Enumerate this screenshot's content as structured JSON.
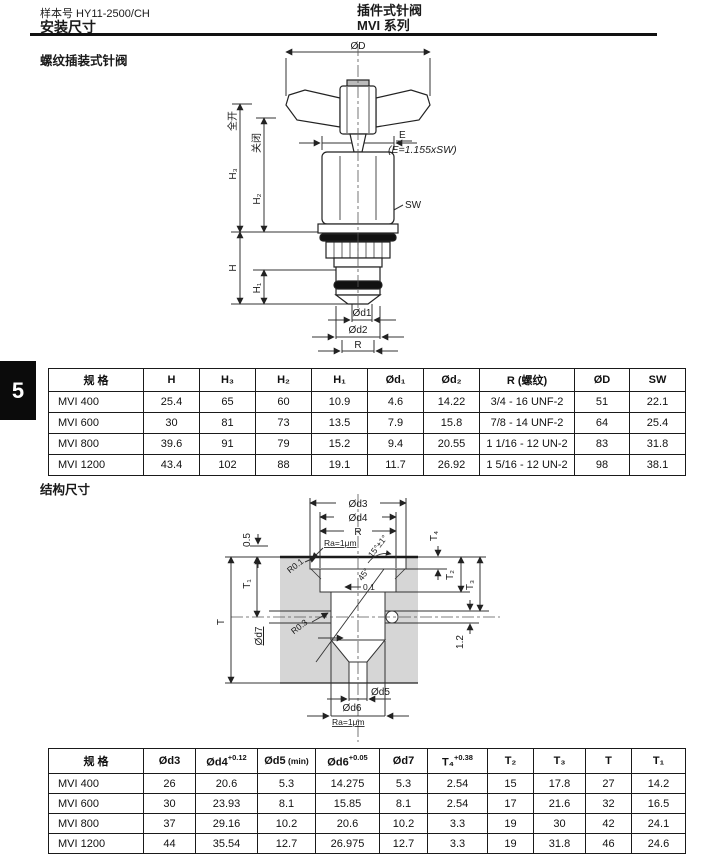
{
  "header": {
    "catalog_no": "样本号 HY11-2500/CH",
    "title_left": "安装尺寸",
    "product_title": "插件式针阀",
    "series": "MVI 系列",
    "tab_number": "5"
  },
  "sections": {
    "mounting_heading": "螺纹插装式针阀",
    "structure_heading": "结构尺寸"
  },
  "drawing1": {
    "labels": {
      "od": "ØD",
      "full_open": "全开",
      "closed": "关闭",
      "h3": "H₃",
      "h2": "H₂",
      "h": "H",
      "h1": "H₁",
      "e": "E",
      "e_formula": "(E=1.155xSW)",
      "sw": "SW",
      "od1": "Ød1",
      "od2": "Ød2",
      "r": "R"
    }
  },
  "drawing2": {
    "labels": {
      "od3": "Ød3",
      "od4": "Ød4",
      "r": "R",
      "ra_top": "Ra=1μm",
      "angle15": "15°±1°",
      "r01": "R0.1",
      "dim05": "0.5",
      "t4": "T₄",
      "t2": "T₂",
      "t3": "T₃",
      "t1": "T₁",
      "t": "T",
      "od7": "Ød7",
      "r03": "R0.3",
      "runout": "0.1",
      "angle45": "45°",
      "dim12": "1.2",
      "od5": "Ød5",
      "od6": "Ød6",
      "ra_bottom": "Ra=1μm"
    }
  },
  "table1": {
    "headers": [
      {
        "b": "规 格"
      },
      {
        "b": "H"
      },
      {
        "b": "H₃"
      },
      {
        "b": "H₂"
      },
      {
        "b": "H₁"
      },
      {
        "b": "Ød₁"
      },
      {
        "b": "Ød₂"
      },
      {
        "b": "R (螺纹)"
      },
      {
        "b": "ØD"
      },
      {
        "b": "SW"
      }
    ],
    "rows": [
      [
        "MVI 400",
        "25.4",
        "65",
        "60",
        "10.9",
        "4.6",
        "14.22",
        "3/4 - 16 UNF-2",
        "51",
        "22.1"
      ],
      [
        "MVI 600",
        "30",
        "81",
        "73",
        "13.5",
        "7.9",
        "15.8",
        "7/8 - 14 UNF-2",
        "64",
        "25.4"
      ],
      [
        "MVI 800",
        "39.6",
        "91",
        "79",
        "15.2",
        "9.4",
        "20.55",
        "1 1/16 - 12 UN-2",
        "83",
        "31.8"
      ],
      [
        "MVI 1200",
        "43.4",
        "102",
        "88",
        "19.1",
        "11.7",
        "26.92",
        "1 5/16 - 12 UN-2",
        "98",
        "38.1"
      ]
    ]
  },
  "table2": {
    "headers": [
      {
        "b": "规 格"
      },
      {
        "b": "Ød3"
      },
      {
        "b": "Ød4",
        "sup": "+0.12"
      },
      {
        "b": "Ød5",
        "small": " (min)"
      },
      {
        "b": "Ød6",
        "sup": "+0.05"
      },
      {
        "b": "Ød7"
      },
      {
        "b": "T₄",
        "sup": "+0.38"
      },
      {
        "b": "T₂"
      },
      {
        "b": "T₃"
      },
      {
        "b": "T"
      },
      {
        "b": "T₁"
      }
    ],
    "rows": [
      [
        "MVI 400",
        "26",
        "20.6",
        "5.3",
        "14.275",
        "5.3",
        "2.54",
        "15",
        "17.8",
        "27",
        "14.2"
      ],
      [
        "MVI 600",
        "30",
        "23.93",
        "8.1",
        "15.85",
        "8.1",
        "2.54",
        "17",
        "21.6",
        "32",
        "16.5"
      ],
      [
        "MVI 800",
        "37",
        "29.16",
        "10.2",
        "20.6",
        "10.2",
        "3.3",
        "19",
        "30",
        "42",
        "24.1"
      ],
      [
        "MVI 1200",
        "44",
        "35.54",
        "12.7",
        "26.975",
        "12.7",
        "3.3",
        "19",
        "31.8",
        "46",
        "24.6"
      ]
    ]
  }
}
